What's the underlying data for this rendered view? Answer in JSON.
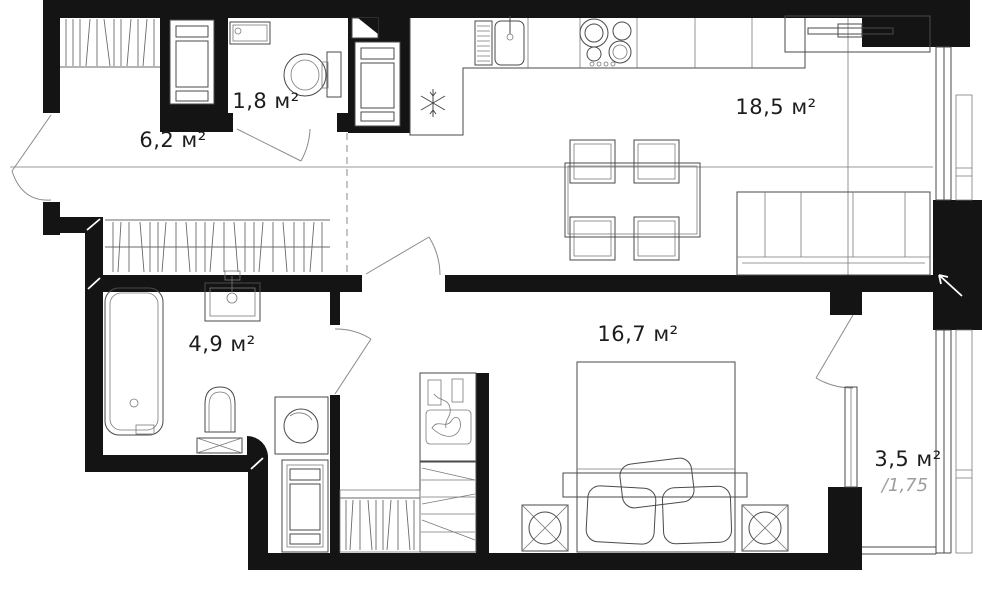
{
  "rooms": {
    "hallway": {
      "area_label": "6,2 м²"
    },
    "wc": {
      "area_label": "1,8 м²"
    },
    "kitchen_living_room": {
      "area_label": "18,5 м²"
    },
    "bathroom": {
      "area_label": "4,9 м²"
    },
    "bedroom": {
      "area_label": "16,7 м²"
    },
    "balcony": {
      "area_label": "3,5 м²",
      "reduced_area_label": "/1,75"
    }
  },
  "icons": {
    "fridge_zone": "snowflake",
    "balcony_wall": "arrow-up-left"
  },
  "colors": {
    "walls": "#141414",
    "furniture_lines": "#4a4a4a",
    "zone_lines": "#9a9a9a",
    "label": "#1c1c1c",
    "muted_label": "#9e9e9e",
    "background": "#ffffff"
  }
}
